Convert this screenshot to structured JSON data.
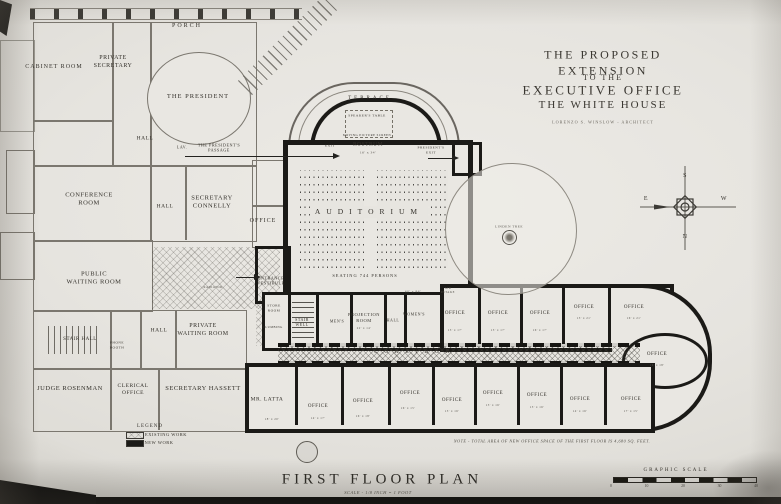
{
  "palette": {
    "paper": "#e7e5e0",
    "ink": "#1b1a17",
    "grey_wall": "#7b776f",
    "faded_ink": "#55524b"
  },
  "title_block": {
    "line1": "THE PROPOSED EXTENSION",
    "line2": "TO THE",
    "line3": "EXECUTIVE OFFICE",
    "line4": "THE WHITE HOUSE",
    "architect": "LORENZO S. WINSLOW - ARCHITECT"
  },
  "footer": {
    "plan_title": "FIRST FLOOR PLAN",
    "scale_note": "SCALE - 1/8 INCH = 1 FOOT",
    "area_note": "NOTE - TOTAL AREA OF NEW OFFICE SPACE OF THE FIRST FLOOR IS 4,680 SQ. FEET.",
    "graphic_scale_label": "GRAPHIC SCALE",
    "scale_ticks": [
      "0",
      "10",
      "20",
      "30",
      "40"
    ]
  },
  "legend": {
    "title": "LEGEND",
    "existing": "EXISTING WORK",
    "new": "NEW WORK"
  },
  "compass": {
    "top": "S",
    "bottom": "N",
    "left": "E",
    "right": "W"
  },
  "rooms": [
    {
      "n": "porch",
      "t": "PORCH",
      "x": 187,
      "y": 27,
      "s": 6,
      "ls": 2
    },
    {
      "n": "cabinet-room",
      "t": "CABINET ROOM",
      "x": 54,
      "y": 68,
      "s": 6,
      "ls": 1
    },
    {
      "n": "private-secretary",
      "t": "PRIVATE\nSECRETARY",
      "x": 113,
      "y": 63,
      "s": 6
    },
    {
      "n": "the-president",
      "t": "THE PRESIDENT",
      "x": 198,
      "y": 97,
      "s": 6.5,
      "ls": 1
    },
    {
      "n": "hall-northwest",
      "t": "HALL",
      "x": 145,
      "y": 139,
      "s": 5.5
    },
    {
      "n": "lavatory",
      "t": "LAV.",
      "x": 182,
      "y": 147,
      "s": 4
    },
    {
      "n": "presidents-passage",
      "t": "THE PRESIDENT'S\nPASSAGE",
      "x": 219,
      "y": 148,
      "s": 4.2
    },
    {
      "n": "conference-room",
      "t": "CONFERENCE\nROOM",
      "x": 89,
      "y": 200,
      "s": 6.5
    },
    {
      "n": "hall-center",
      "t": "HALL",
      "x": 165,
      "y": 207,
      "s": 5.5
    },
    {
      "n": "secretary-connelly",
      "t": "SECRETARY\nCONNELLY",
      "x": 212,
      "y": 203,
      "s": 6.5
    },
    {
      "n": "office-west",
      "t": "OFFICE",
      "x": 263,
      "y": 222,
      "s": 6,
      "ls": 1
    },
    {
      "n": "public-waiting-room",
      "t": "PUBLIC\nWAITING ROOM",
      "x": 94,
      "y": 279,
      "s": 6.5
    },
    {
      "n": "entrance-vestibule",
      "t": "ENTRANCE\nVESTIBULE",
      "x": 271,
      "y": 281,
      "s": 4.2
    },
    {
      "n": "radiator",
      "t": "RADIATOR",
      "x": 213,
      "y": 288,
      "s": 3,
      "d": 1
    },
    {
      "n": "stair-hall",
      "t": "STAIR HALL",
      "x": 80,
      "y": 340,
      "s": 5
    },
    {
      "n": "phone-booth",
      "t": "PHONE\nBOOTH",
      "x": 117,
      "y": 345,
      "s": 3.5
    },
    {
      "n": "hall-south",
      "t": "HALL",
      "x": 159,
      "y": 331,
      "s": 5.5
    },
    {
      "n": "private-waiting-room",
      "t": "PRIVATE\nWAITING ROOM",
      "x": 203,
      "y": 331,
      "s": 6
    },
    {
      "n": "judge-rosenman",
      "t": "JUDGE ROSENMAN",
      "x": 70,
      "y": 389,
      "s": 6.5
    },
    {
      "n": "clerical-office",
      "t": "CLERICAL\nOFFICE",
      "x": 133,
      "y": 390,
      "s": 5.5
    },
    {
      "n": "secretary-hassett",
      "t": "SECRETARY HASSETT",
      "x": 203,
      "y": 389,
      "s": 6.5
    },
    {
      "n": "terrace",
      "t": "TERRACE",
      "x": 370,
      "y": 99,
      "s": 5,
      "ls": 3
    },
    {
      "n": "speakers-table",
      "t": "SPEAKER'S TABLE",
      "x": 367,
      "y": 116,
      "s": 3.5
    },
    {
      "n": "picture-screen",
      "t": "MOVING PICTURE SCREEN",
      "x": 367,
      "y": 136,
      "s": 3
    },
    {
      "n": "rostrum",
      "t": "ROSTRUM",
      "x": 368,
      "y": 145,
      "s": 5.5
    },
    {
      "n": "rostrum-dim",
      "t": "16' x 34'",
      "x": 368,
      "y": 153,
      "s": 3.5,
      "d": 1
    },
    {
      "n": "exit-west",
      "t": "EXIT",
      "x": 330,
      "y": 146,
      "s": 3.5
    },
    {
      "n": "presidents-exit",
      "t": "PRESIDENT'S\nEXIT",
      "x": 431,
      "y": 150,
      "s": 3.5
    },
    {
      "n": "auditorium",
      "t": "AUDITORIUM",
      "x": 369,
      "y": 212,
      "s": 7.5,
      "ls": 6,
      "bg": 1
    },
    {
      "n": "seating-capacity",
      "t": "SEATING 744 PERSONS",
      "x": 365,
      "y": 276,
      "s": 4.4,
      "ls": 1
    },
    {
      "n": "auditorium-dim",
      "t": "60' x 86'",
      "x": 413,
      "y": 292,
      "s": 3.5,
      "d": 1
    },
    {
      "n": "air-intake",
      "t": "AIR\nINTAKE",
      "x": 448,
      "y": 291,
      "s": 3,
      "d": 1
    },
    {
      "n": "store-room",
      "t": "STORE\nROOM",
      "x": 274,
      "y": 308,
      "s": 3.5
    },
    {
      "n": "plumbing",
      "t": "PLUMBING",
      "x": 273,
      "y": 328,
      "s": 3
    },
    {
      "n": "stair-well",
      "t": "STAIR\nWELL",
      "x": 302,
      "y": 322,
      "s": 4
    },
    {
      "n": "mens-room",
      "t": "MEN'S",
      "x": 337,
      "y": 321,
      "s": 4
    },
    {
      "n": "projection-room",
      "t": "PROJECTION\nROOM",
      "x": 364,
      "y": 318,
      "s": 4.5
    },
    {
      "n": "projection-dim",
      "t": "22' x 14'",
      "x": 364,
      "y": 329,
      "s": 3,
      "d": 1
    },
    {
      "n": "hall-east",
      "t": "HALL",
      "x": 393,
      "y": 320,
      "s": 4
    },
    {
      "n": "womens-room",
      "t": "WOMEN'S",
      "x": 414,
      "y": 314,
      "s": 4
    },
    {
      "n": "corridor",
      "t": "CORRIDOR",
      "x": 415,
      "y": 353,
      "s": 5,
      "ls": 7
    },
    {
      "n": "office-n1",
      "t": "OFFICE",
      "x": 455,
      "y": 314,
      "s": 5
    },
    {
      "n": "office-n1-dim",
      "t": "15' x 17'",
      "x": 455,
      "y": 331,
      "s": 3,
      "d": 1
    },
    {
      "n": "office-n2",
      "t": "OFFICE",
      "x": 498,
      "y": 314,
      "s": 5
    },
    {
      "n": "office-n2-dim",
      "t": "15' x 17'",
      "x": 498,
      "y": 331,
      "s": 3,
      "d": 1
    },
    {
      "n": "office-n3",
      "t": "OFFICE",
      "x": 540,
      "y": 314,
      "s": 5
    },
    {
      "n": "office-n3-dim",
      "t": "16' x 17'",
      "x": 540,
      "y": 331,
      "s": 3,
      "d": 1
    },
    {
      "n": "office-n4",
      "t": "OFFICE",
      "x": 584,
      "y": 308,
      "s": 5
    },
    {
      "n": "office-n4-dim",
      "t": "15' x 21'",
      "x": 584,
      "y": 319,
      "s": 3,
      "d": 1
    },
    {
      "n": "office-n5",
      "t": "OFFICE",
      "x": 634,
      "y": 308,
      "s": 5
    },
    {
      "n": "office-n5-dim",
      "t": "16' x 21'",
      "x": 634,
      "y": 319,
      "s": 3,
      "d": 1
    },
    {
      "n": "office-east-oval",
      "t": "OFFICE",
      "x": 657,
      "y": 355,
      "s": 5
    },
    {
      "n": "office-east-oval-dim",
      "t": "16' x 18'",
      "x": 657,
      "y": 366,
      "s": 3,
      "d": 1
    },
    {
      "n": "mr-latta",
      "t": "MR. LATTA",
      "x": 267,
      "y": 400,
      "s": 5.5
    },
    {
      "n": "mr-latta-dim",
      "t": "18' x 20'",
      "x": 272,
      "y": 420,
      "s": 3,
      "d": 1
    },
    {
      "n": "office-s1",
      "t": "OFFICE",
      "x": 318,
      "y": 407,
      "s": 5
    },
    {
      "n": "office-s1-dim",
      "t": "14' x 17'",
      "x": 318,
      "y": 419,
      "s": 3,
      "d": 1
    },
    {
      "n": "office-s2",
      "t": "OFFICE",
      "x": 363,
      "y": 402,
      "s": 5
    },
    {
      "n": "office-s2-dim",
      "t": "16' x 18'",
      "x": 363,
      "y": 417,
      "s": 3,
      "d": 1
    },
    {
      "n": "office-s3",
      "t": "OFFICE",
      "x": 410,
      "y": 394,
      "s": 5
    },
    {
      "n": "office-s3-dim",
      "t": "16' x 15'",
      "x": 408,
      "y": 409,
      "s": 3,
      "d": 1
    },
    {
      "n": "office-s4",
      "t": "OFFICE",
      "x": 452,
      "y": 401,
      "s": 5
    },
    {
      "n": "office-s4-dim",
      "t": "15' x 16'",
      "x": 452,
      "y": 412,
      "s": 3,
      "d": 1
    },
    {
      "n": "office-s5",
      "t": "OFFICE",
      "x": 493,
      "y": 394,
      "s": 5
    },
    {
      "n": "office-s5-dim",
      "t": "15' x 16'",
      "x": 493,
      "y": 406,
      "s": 3,
      "d": 1
    },
    {
      "n": "office-s6",
      "t": "OFFICE",
      "x": 537,
      "y": 396,
      "s": 5
    },
    {
      "n": "office-s6-dim",
      "t": "15' x 16'",
      "x": 537,
      "y": 408,
      "s": 3,
      "d": 1
    },
    {
      "n": "office-s7",
      "t": "OFFICE",
      "x": 580,
      "y": 400,
      "s": 5
    },
    {
      "n": "office-s7-dim",
      "t": "14' x 16'",
      "x": 580,
      "y": 412,
      "s": 3,
      "d": 1
    },
    {
      "n": "office-s8",
      "t": "OFFICE",
      "x": 631,
      "y": 400,
      "s": 5
    },
    {
      "n": "office-s8-dim",
      "t": "17' x 15'",
      "x": 631,
      "y": 412,
      "s": 3,
      "d": 1
    },
    {
      "n": "linden-tree",
      "t": "LINDEN TREE",
      "x": 509,
      "y": 227,
      "s": 3.5,
      "d": 1
    }
  ]
}
